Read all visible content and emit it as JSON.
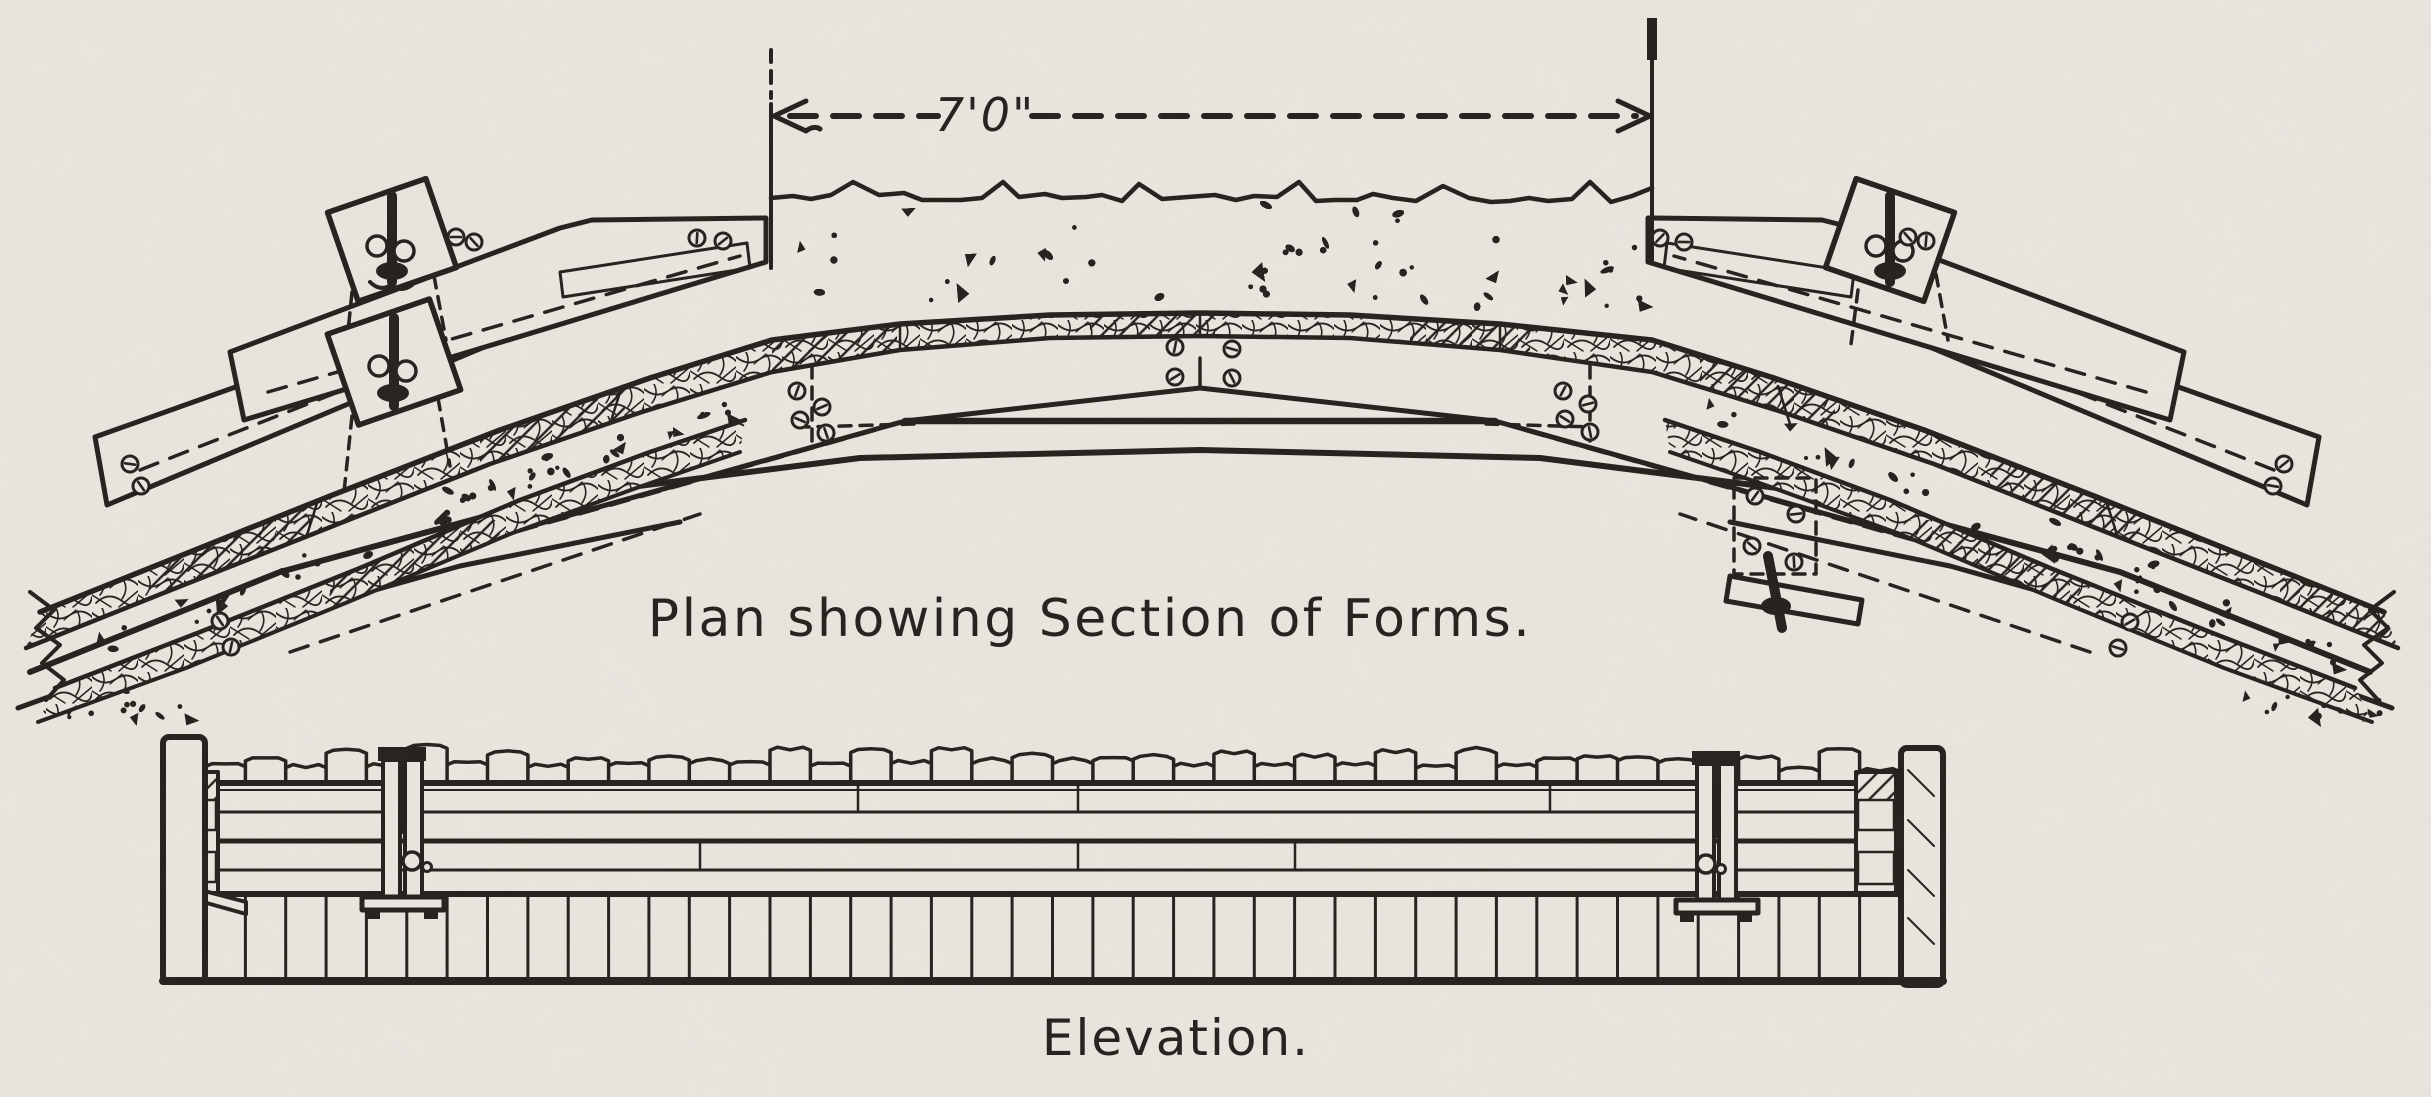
{
  "drawing": {
    "paper_color": "#eae7e1",
    "ink_color": "#221e19",
    "dimension": {
      "label": "7'0\""
    },
    "plan": {
      "caption": "Plan showing Section of Forms."
    },
    "elevation": {
      "caption": "Elevation."
    }
  }
}
